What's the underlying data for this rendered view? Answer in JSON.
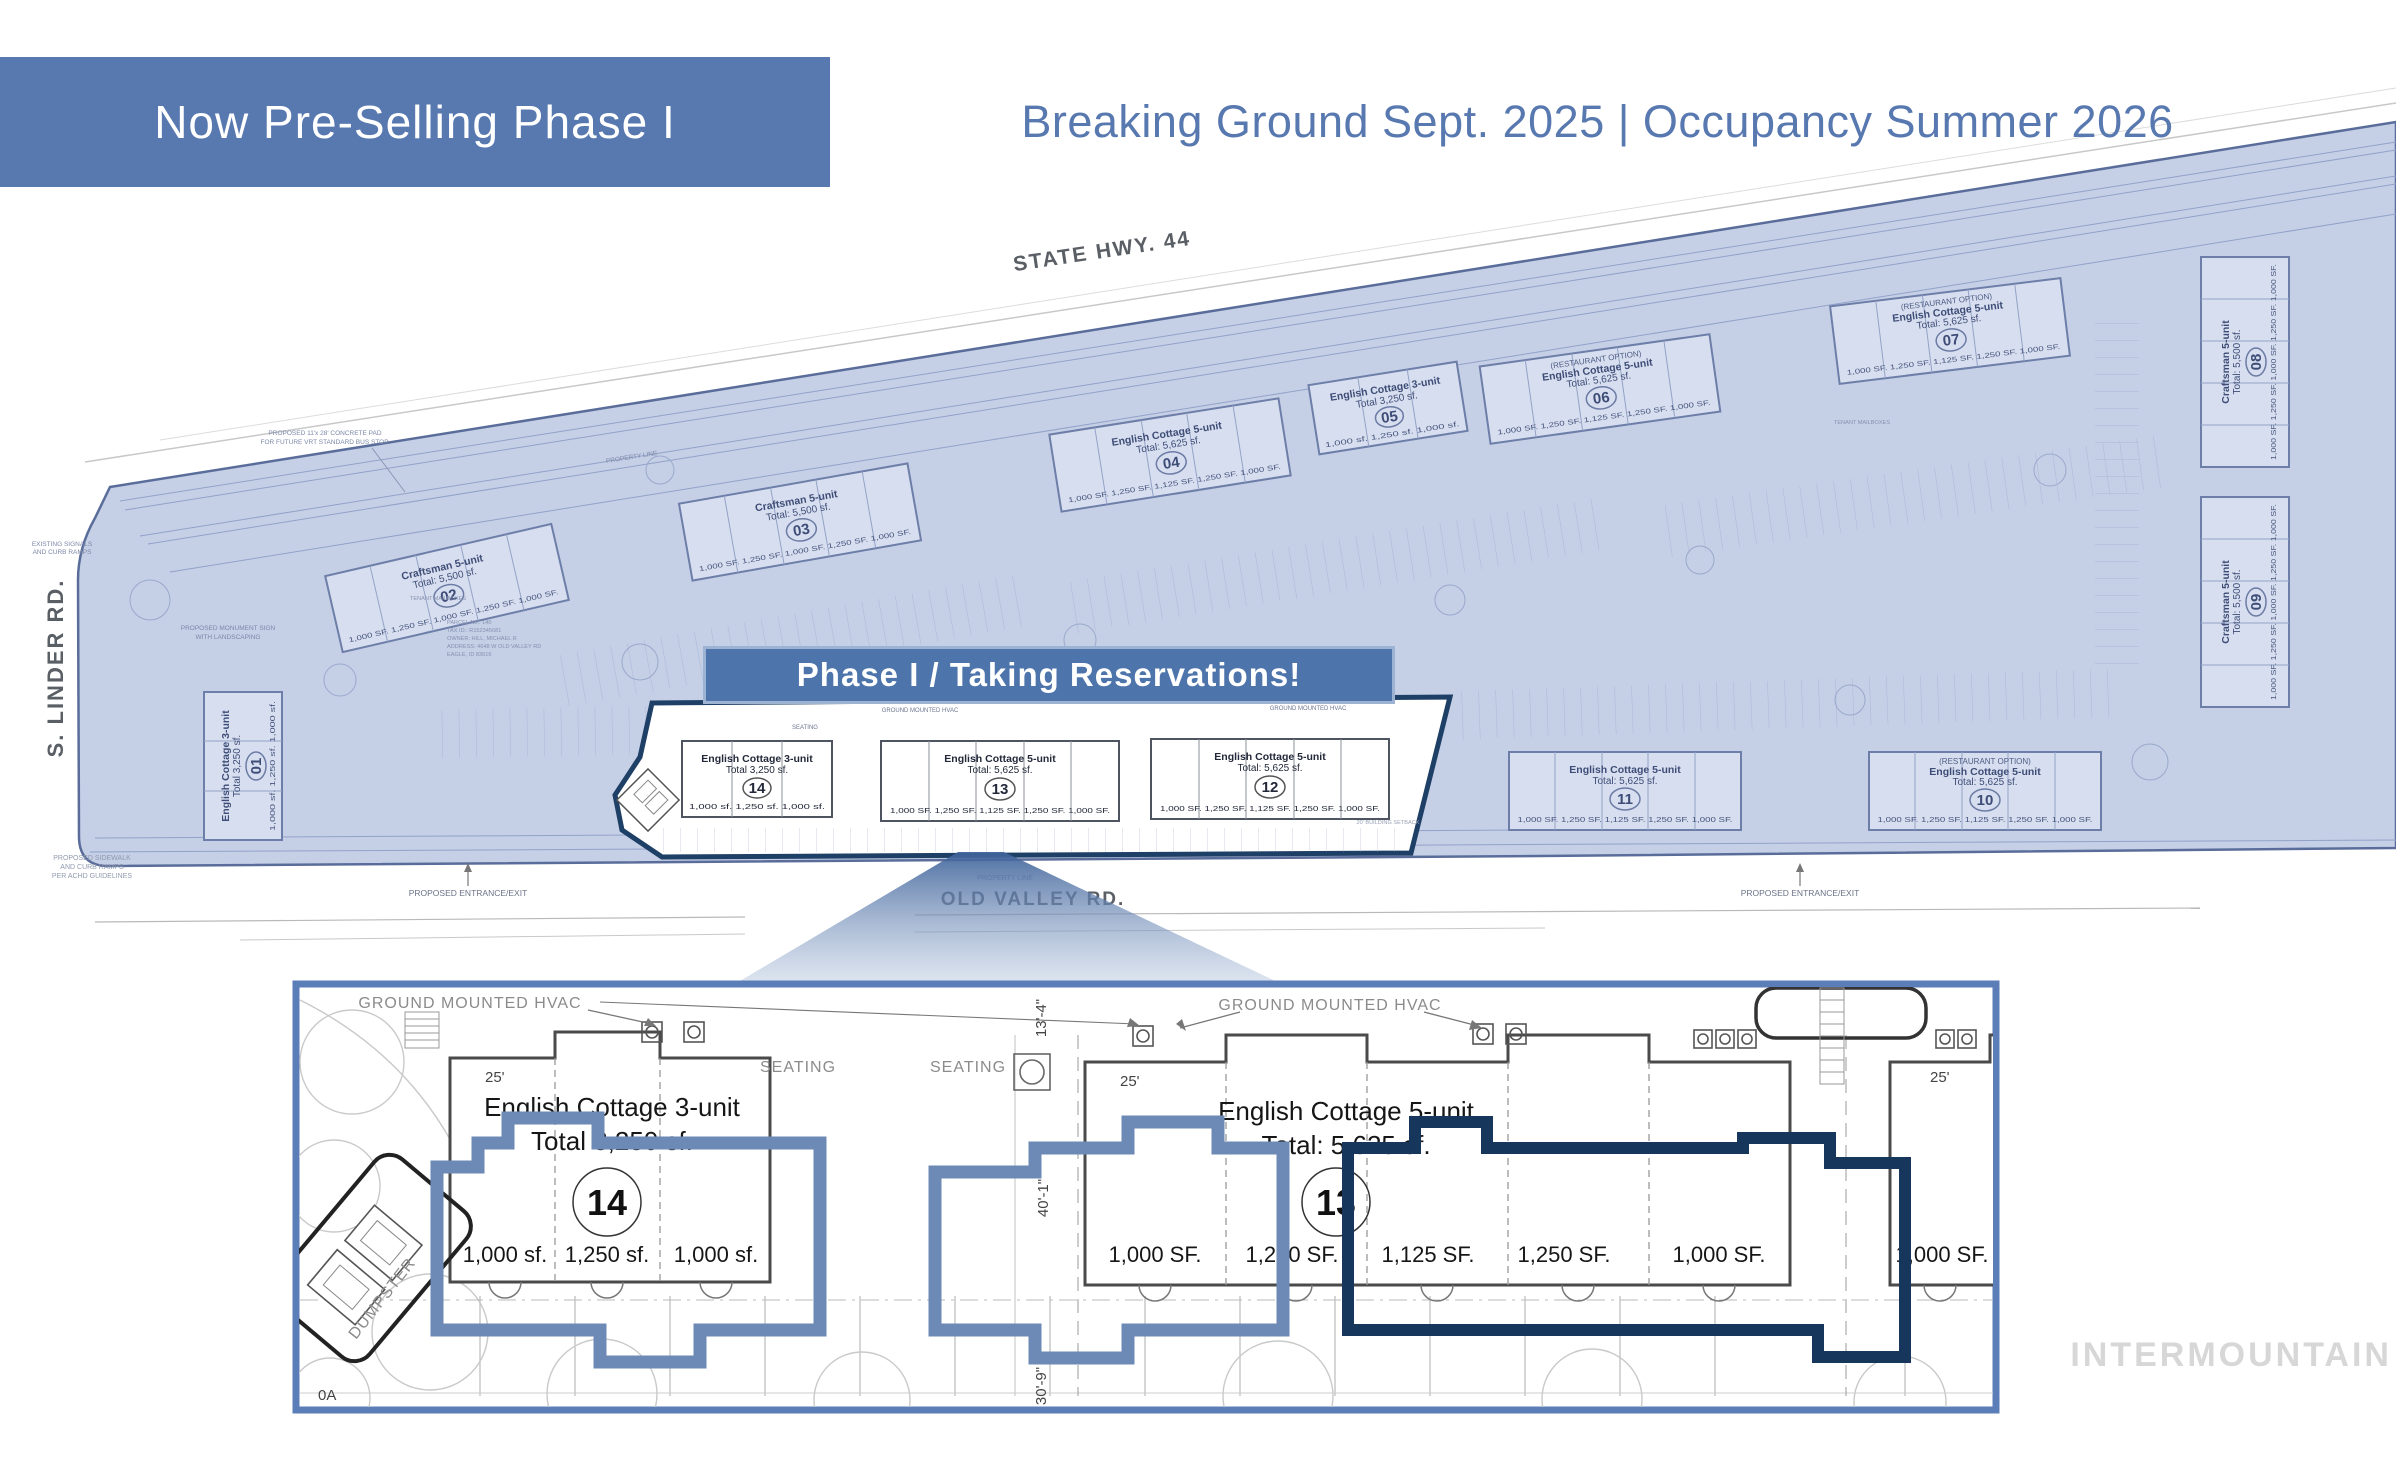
{
  "header": {
    "banner_label": "Now Pre-Selling Phase I",
    "schedule": "Breaking Ground Sept. 2025 | Occupancy Summer 2026"
  },
  "colors": {
    "banner_bg": "#5878b0",
    "schedule_text": "#5878b0",
    "site_tint": "#c5cfe6",
    "site_outline": "#5a6d9a",
    "phase_banner_bg": "#4d74ab",
    "phase_area_outline": "#1e3f66",
    "highlight_blue": "#6d89b6",
    "highlight_navy": "#16365c",
    "detail_border": "#5b7db8"
  },
  "roads": {
    "highway": "STATE HWY. 44",
    "west": "S. LINDER RD.",
    "south": "OLD VALLEY RD."
  },
  "phase_banner_label": "Phase I / Taking Reservations!",
  "annotations": {
    "bus_pad_line1": "PROPOSED 11'x 28' CONCRETE PAD",
    "bus_pad_line2": "FOR FUTURE VRT STANDARD BUS STOP.",
    "monument_line1": "PROPOSED MONUMENT SIGN",
    "monument_line2": "WITH LANDSCAPING",
    "sidewalk_line1": "PROPOSED SIDEWALK",
    "sidewalk_line2": "AND CURB RAMPS",
    "sidewalk_line3": "PER ACHD GUIDELINES",
    "existing_line1": "EXISTING SIGNALS",
    "existing_line2": "AND CURB RAMPS",
    "entrance_left": "PROPOSED ENTRANCE/EXIT",
    "entrance_right": "PROPOSED ENTRANCE/EXIT",
    "property_line_top": "PROPERTY LINE",
    "property_line_bottom": "PROPERTY LINE",
    "tenant_mailboxes_left": "TENANT MAILBOXES",
    "tenant_mailboxes_right": "TENANT MAILBOXES",
    "seating_small": "SEATING",
    "setback": "20' BUILDING SETBACK",
    "hvac_small_left": "GROUND MOUNTED HVAC",
    "hvac_small_right": "GROUND MOUNTED HVAC",
    "parcel_line1": "PARCEL No.: 140",
    "parcel_line2": "TAX ID.: R152345681",
    "parcel_line3": "OWNER: HILL, MICHAEL R",
    "parcel_line4": "ADDRESS: 4648 W OLD VALLEY RD",
    "parcel_line5": "EAGLE, ID 83616"
  },
  "buildings": [
    {
      "num": "01",
      "title": "English Cottage 3-unit",
      "total": "Total 3,250 sf.",
      "units": "1,000 sf.  1,250 sf.  1,000 sf."
    },
    {
      "num": "02",
      "title": "Craftsman 5-unit",
      "total": "Total: 5,500 sf.",
      "units": "1,000 SF.  1,250 SF.  1,000 SF.  1,250 SF.  1,000 SF."
    },
    {
      "num": "03",
      "title": "Craftsman 5-unit",
      "total": "Total: 5,500 sf.",
      "units": "1,000 SF.  1,250 SF.  1,000 SF.  1,250 SF.  1,000 SF."
    },
    {
      "num": "04",
      "title": "English Cottage 5-unit",
      "total": "Total: 5,625 sf.",
      "units": "1,000 SF.  1,250 SF.  1,125 SF.  1,250 SF.  1,000 SF."
    },
    {
      "num": "05",
      "title": "English Cottage 3-unit",
      "total": "Total 3,250 sf.",
      "units": "1,000 sf.  1,250 sf.  1,000 sf."
    },
    {
      "num": "06",
      "option": "(RESTAURANT OPTION)",
      "title": "English Cottage 5-unit",
      "total": "Total: 5,625 sf.",
      "units": "1,000 SF.  1,250 SF.  1,125 SF.  1,250 SF.  1,000 SF."
    },
    {
      "num": "07",
      "option": "(RESTAURANT OPTION)",
      "title": "English Cottage 5-unit",
      "total": "Total: 5,625 sf.",
      "units": "1,000 SF.  1,250 SF.  1,125 SF.  1,250 SF.  1,000 SF."
    },
    {
      "num": "08",
      "title": "Craftsman 5-unit",
      "total": "Total: 5,500 sf.",
      "units": "1,000 SF.  1,250 SF.  1,000 SF.  1,250 SF.  1,000 SF."
    },
    {
      "num": "09",
      "title": "Craftsman 5-unit",
      "total": "Total: 5,500 sf.",
      "units": "1,000 SF.  1,250 SF.  1,000 SF.  1,250 SF.  1,000 SF."
    },
    {
      "num": "10",
      "option": "(RESTAURANT OPTION)",
      "title": "English Cottage 5-unit",
      "total": "Total: 5,625 sf.",
      "units": "1,000 SF.  1,250 SF.  1,125 SF.  1,250 SF.  1,000 SF."
    },
    {
      "num": "11",
      "title": "English Cottage 5-unit",
      "total": "Total: 5,625 sf.",
      "units": "1,000 SF.  1,250 SF.  1,125 SF.  1,250 SF.  1,000 SF."
    },
    {
      "num": "12",
      "title": "English Cottage 5-unit",
      "total": "Total: 5,625 sf.",
      "units": "1,000 SF.  1,250 SF.  1,125 SF.  1,250 SF.  1,000 SF."
    },
    {
      "num": "13",
      "title": "English Cottage 5-unit",
      "total": "Total: 5,625 sf.",
      "units": "1,000 SF.  1,250 SF.  1,125 SF.  1,250 SF.  1,000 SF."
    },
    {
      "num": "14",
      "title": "English Cottage 3-unit",
      "total": "Total 3,250 sf.",
      "units": "1,000 sf.  1,250 sf.  1,000 sf."
    }
  ],
  "detail": {
    "hvac_left": "GROUND MOUNTED HVAC",
    "hvac_right": "GROUND MOUNTED HVAC",
    "seating_1": "SEATING",
    "seating_2": "SEATING",
    "dumpster": "DUMPSTER",
    "corner": "0A",
    "dim_1": "13'-4\"",
    "dim_2": "40'-1\"",
    "dim_3": "30'-9\"",
    "b14": {
      "dim": "25'",
      "title": "English Cottage 3-unit",
      "total": "Total 3,250 sf.",
      "num": "14",
      "units": [
        "1,000 sf.",
        "1,250 sf.",
        "1,000 sf."
      ]
    },
    "b13": {
      "dim": "25'",
      "title": "English Cottage 5-unit",
      "total": "Total: 5,625 sf.",
      "num": "13",
      "units": [
        "1,000 SF.",
        "1,250 SF.",
        "1,125 SF.",
        "1,250 SF.",
        "1,000 SF."
      ]
    },
    "b12": {
      "dim": "25'",
      "unit1": "1,000 SF."
    }
  },
  "watermark": "INTERMOUNTAIN"
}
